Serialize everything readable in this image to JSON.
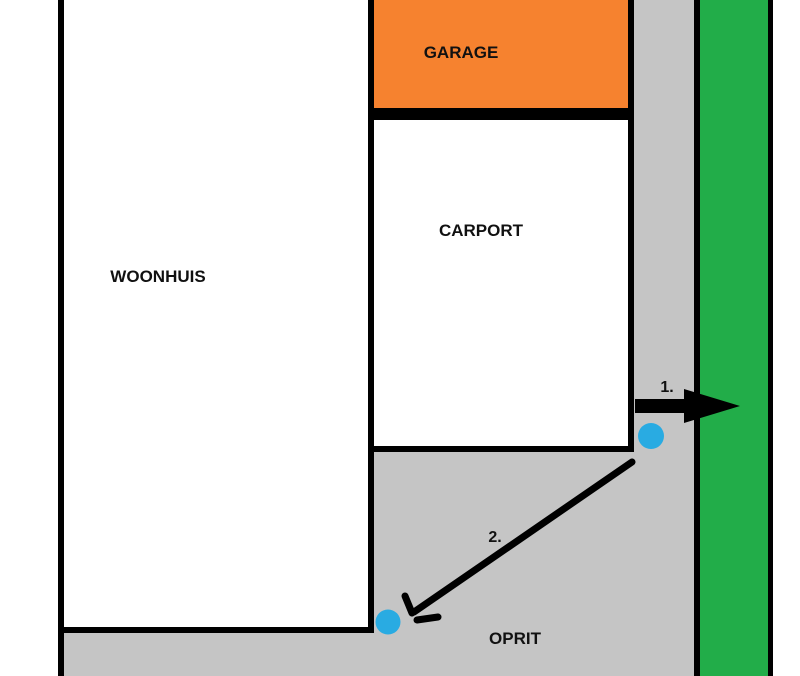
{
  "diagram": {
    "title": "site-plan-sketch",
    "labels": {
      "house": "WOONHUIS",
      "garage": "GARAGE",
      "carport": "CARPORT",
      "driveway": "OPRIT",
      "step1": "1.",
      "step2": "2."
    },
    "colors": {
      "garage_fill": "#F6822F",
      "driveway_fill": "#C5C5C5",
      "green_strip_fill": "#22AD49",
      "marker_blue": "#29ABE2",
      "outline": "#000000"
    },
    "markers": {
      "point1": "blue-dot near arrow 1 (driveway exit to green strip)",
      "point2": "blue-dot near arrow 2 (house rear corner on driveway)"
    }
  }
}
